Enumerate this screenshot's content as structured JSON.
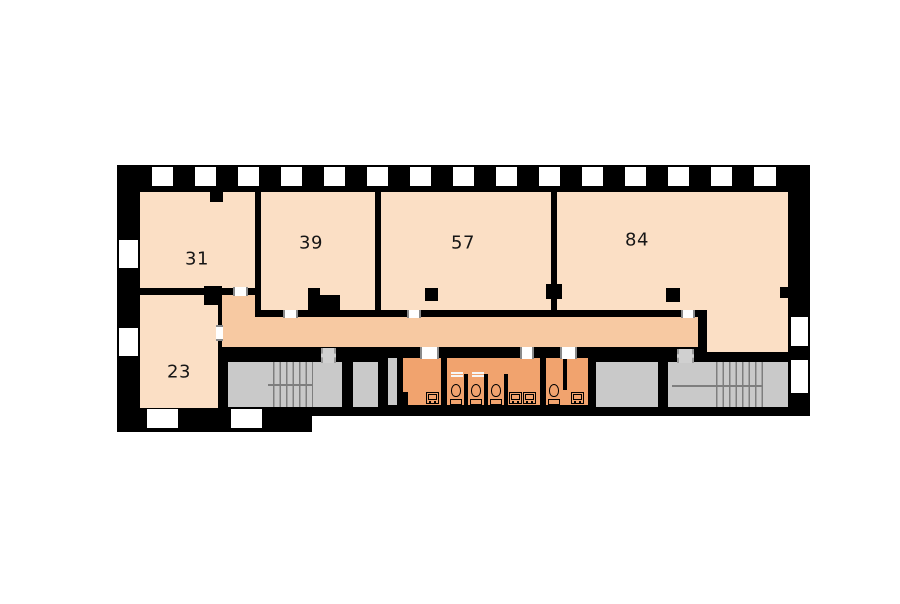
{
  "floorplan": {
    "colors": {
      "bg": "#ffffff",
      "wall": "#000000",
      "room": "#fbdfc5",
      "corridor": "#f7c9a2",
      "bath": "#f1a36e",
      "gray": "#c9c9c9"
    },
    "rooms": [
      {
        "id": "room-31",
        "label": "31"
      },
      {
        "id": "room-39",
        "label": "39"
      },
      {
        "id": "room-57",
        "label": "57"
      },
      {
        "id": "room-84",
        "label": "84"
      },
      {
        "id": "room-23",
        "label": "23"
      }
    ],
    "fixtures": {
      "toilets": 4,
      "sinks": 4,
      "stairwells": 2
    }
  }
}
